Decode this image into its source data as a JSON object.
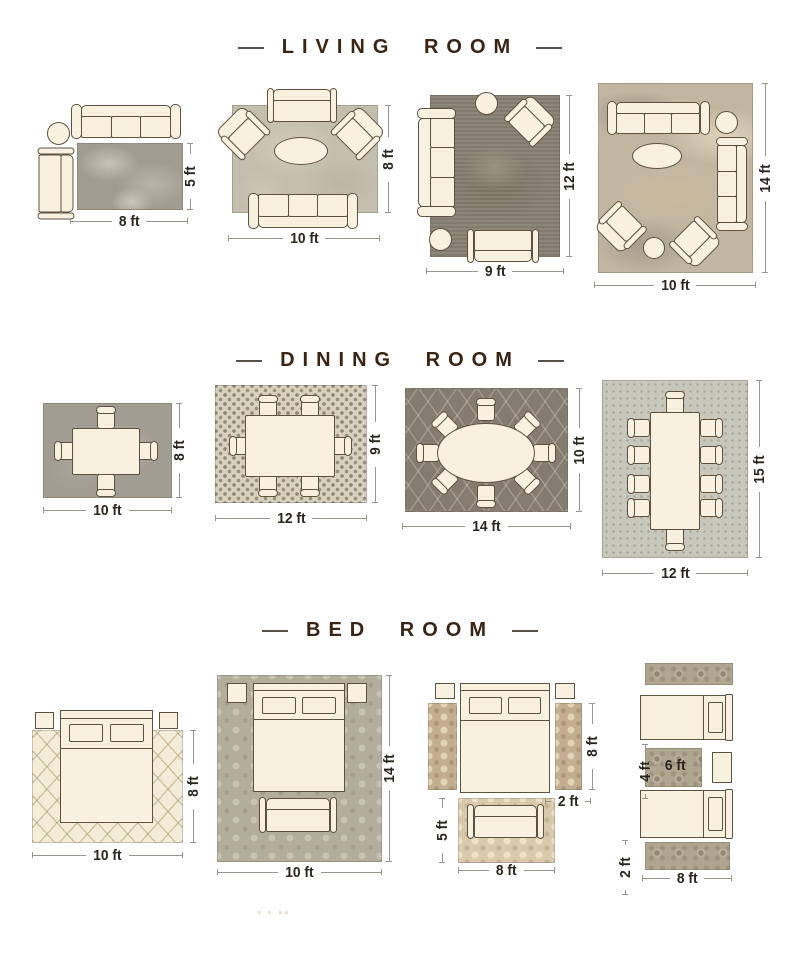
{
  "colors": {
    "background": "#ffffff",
    "title_text": "#3a2414",
    "dimension_text": "#29251f",
    "furniture_fill": "#f8f1e0",
    "furniture_outline": "#5f5140"
  },
  "sections": [
    {
      "id": "living-room",
      "title": "LIVING ROOM",
      "layouts": [
        {
          "id": "living-8x5",
          "width_label": "8 ft",
          "height_label": "5 ft"
        },
        {
          "id": "living-10x8",
          "width_label": "10 ft",
          "height_label": "8 ft"
        },
        {
          "id": "living-9x12",
          "width_label": "9 ft",
          "height_label": "12 ft"
        },
        {
          "id": "living-10x14",
          "width_label": "10 ft",
          "height_label": "14 ft"
        }
      ]
    },
    {
      "id": "dining-room",
      "title": "DINING ROOM",
      "layouts": [
        {
          "id": "dining-10x8",
          "width_label": "10 ft",
          "height_label": "8 ft"
        },
        {
          "id": "dining-12x9",
          "width_label": "12 ft",
          "height_label": "9 ft"
        },
        {
          "id": "dining-14x10",
          "width_label": "14 ft",
          "height_label": "10 ft"
        },
        {
          "id": "dining-12x15",
          "width_label": "12 ft",
          "height_label": "15 ft"
        }
      ]
    },
    {
      "id": "bed-room",
      "title": "BED ROOM",
      "layouts": [
        {
          "id": "bed-10x8",
          "width_label": "10 ft",
          "height_label": "8 ft"
        },
        {
          "id": "bed-10x14",
          "width_label": "10 ft",
          "height_label": "14 ft"
        },
        {
          "id": "bed-runners-foot-rug",
          "width_label": "8 ft",
          "foot_rug_height_label": "5 ft",
          "runner_height_label": "8 ft",
          "runner_width_label": "2 ft"
        },
        {
          "id": "bed-twin-runners",
          "width_label": "8 ft",
          "runner_width_label": "2 ft",
          "middle_rug_width_label": "6 ft",
          "middle_rug_height_label": "4 ft"
        }
      ]
    }
  ]
}
